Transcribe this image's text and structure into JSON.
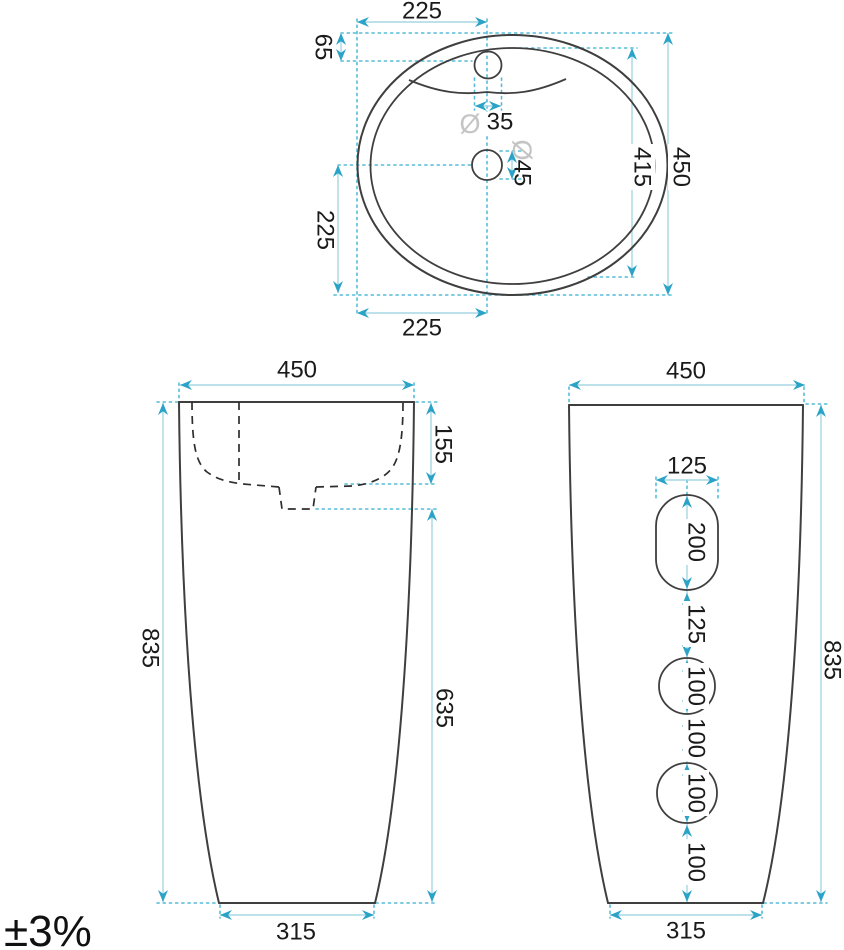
{
  "drawing_type": "pedestal-washbasin-dimension-drawing",
  "tolerance": {
    "note": "±3%"
  },
  "symbols": {
    "diameter": "Ø"
  },
  "colors": {
    "background": "#ffffff",
    "outline": "#3f3f3f",
    "dimension_line": "#a6d7e4",
    "extension_line": "#55bcd7",
    "arrow": "#2aa3c6",
    "text": "#1a1a1a",
    "diameter_symbol": "#c4c4c4"
  },
  "top_view": {
    "dims": {
      "center_offset_top": "225",
      "rim_to_faucet": "65",
      "faucet_hole_diameter": "35",
      "drain_diameter": "45",
      "basin_span": "415",
      "overall_diameter": "450",
      "center_to_bottom_edge": "225",
      "center_offset_bottom": "225"
    }
  },
  "front_view": {
    "dims": {
      "top_width": "450",
      "basin_depth": "155",
      "overall_height": "835",
      "pedestal_height": "635",
      "bottom_width": "315"
    }
  },
  "back_view": {
    "dims": {
      "top_width": "450",
      "slot_width": "125",
      "slot_height": "200",
      "slot_to_hole_gap": "125",
      "upper_hole_diameter": "100",
      "hole_gap": "100",
      "lower_hole_diameter": "100",
      "hole_to_bottom": "100",
      "overall_height": "835",
      "bottom_width": "315"
    }
  }
}
